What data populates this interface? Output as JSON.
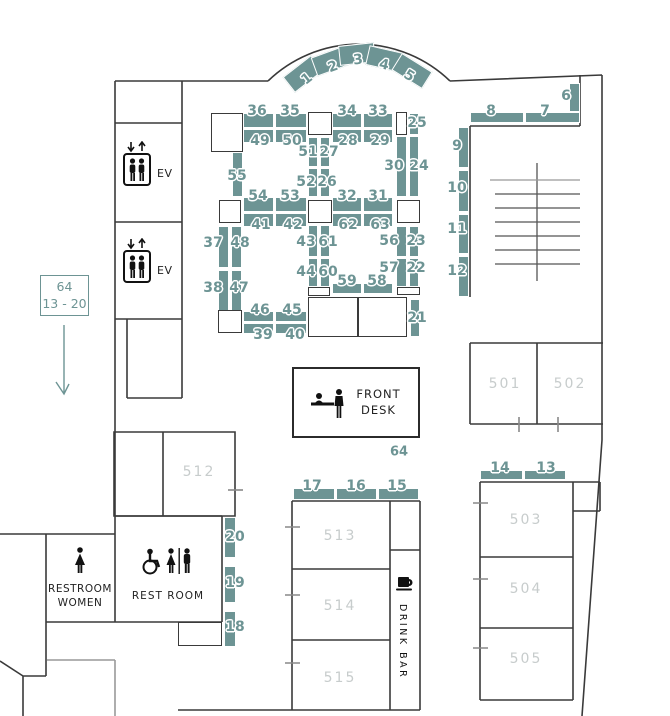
{
  "colors": {
    "booth_fill": "#6d9494",
    "number_text": "#6d9494",
    "room_label_text": "#c7cccc",
    "wall": "#3a3a3a"
  },
  "legend": {
    "text": "64\n13 - 20"
  },
  "elevator": {
    "label": "EV"
  },
  "front_desk": {
    "label": "FRONT\nDESK",
    "booth_num": "64"
  },
  "drink_bar": {
    "label": "DRINK BAR"
  },
  "restrooms": {
    "women": "RESTROOM\nWOMEN",
    "accessible": "REST ROOM"
  },
  "room_labels": [
    {
      "text": "501",
      "x": 505,
      "y": 384
    },
    {
      "text": "502",
      "x": 570,
      "y": 384
    },
    {
      "text": "503",
      "x": 526,
      "y": 520
    },
    {
      "text": "504",
      "x": 526,
      "y": 589
    },
    {
      "text": "505",
      "x": 526,
      "y": 659
    },
    {
      "text": "512",
      "x": 199,
      "y": 472
    },
    {
      "text": "513",
      "x": 340,
      "y": 536
    },
    {
      "text": "514",
      "x": 340,
      "y": 606
    },
    {
      "text": "515",
      "x": 340,
      "y": 678
    }
  ],
  "booths": [
    {
      "n": "1",
      "x": 285,
      "y": 64,
      "w": 36,
      "h": 20,
      "r": -38,
      "lx": 307,
      "ly": 79
    },
    {
      "n": "2",
      "x": 313,
      "y": 51,
      "w": 36,
      "h": 20,
      "r": -20,
      "lx": 333,
      "ly": 67
    },
    {
      "n": "3",
      "x": 339,
      "y": 44,
      "w": 36,
      "h": 20,
      "r": -6,
      "lx": 358,
      "ly": 60
    },
    {
      "n": "4",
      "x": 367,
      "y": 49,
      "w": 36,
      "h": 20,
      "r": 13,
      "lx": 384,
      "ly": 65
    },
    {
      "n": "5",
      "x": 394,
      "y": 61,
      "w": 36,
      "h": 20,
      "r": 32,
      "lx": 409,
      "ly": 76
    },
    {
      "n": "6",
      "x": 569,
      "y": 83,
      "w": 11,
      "h": 29,
      "lx": 566,
      "ly": 96
    },
    {
      "n": "7",
      "x": 525,
      "y": 112,
      "w": 55,
      "h": 11,
      "lx": 545,
      "ly": 111
    },
    {
      "n": "8",
      "x": 470,
      "y": 112,
      "w": 54,
      "h": 11,
      "lx": 491,
      "ly": 111
    },
    {
      "n": "9",
      "x": 458,
      "y": 127,
      "w": 11,
      "h": 41,
      "lx": 457,
      "ly": 146
    },
    {
      "n": "10",
      "x": 458,
      "y": 170,
      "w": 11,
      "h": 42,
      "lx": 457,
      "ly": 188
    },
    {
      "n": "11",
      "x": 458,
      "y": 214,
      "w": 11,
      "h": 40,
      "lx": 457,
      "ly": 229
    },
    {
      "n": "12",
      "x": 458,
      "y": 256,
      "w": 11,
      "h": 41,
      "lx": 457,
      "ly": 271
    },
    {
      "n": "36",
      "x": 243,
      "y": 113,
      "w": 31,
      "h": 15,
      "lx": 257,
      "ly": 111
    },
    {
      "n": "35",
      "x": 275,
      "y": 113,
      "w": 32,
      "h": 15,
      "lx": 290,
      "ly": 111
    },
    {
      "n": "49",
      "x": 243,
      "y": 129,
      "w": 31,
      "h": 14,
      "lx": 260,
      "ly": 141
    },
    {
      "n": "50",
      "x": 275,
      "y": 129,
      "w": 32,
      "h": 14,
      "lx": 292,
      "ly": 141
    },
    {
      "n": "55",
      "x": 232,
      "y": 152,
      "w": 11,
      "h": 45,
      "lx": 237,
      "ly": 176
    },
    {
      "n": "54",
      "x": 243,
      "y": 197,
      "w": 31,
      "h": 15,
      "lx": 258,
      "ly": 196
    },
    {
      "n": "53",
      "x": 275,
      "y": 197,
      "w": 32,
      "h": 15,
      "lx": 290,
      "ly": 196
    },
    {
      "n": "41",
      "x": 243,
      "y": 213,
      "w": 31,
      "h": 14,
      "lx": 261,
      "ly": 225
    },
    {
      "n": "42",
      "x": 275,
      "y": 213,
      "w": 32,
      "h": 14,
      "lx": 293,
      "ly": 225
    },
    {
      "n": "37",
      "x": 218,
      "y": 226,
      "w": 11,
      "h": 42,
      "lx": 213,
      "ly": 243
    },
    {
      "n": "48",
      "x": 231,
      "y": 226,
      "w": 11,
      "h": 42,
      "lx": 240,
      "ly": 243
    },
    {
      "n": "38",
      "x": 218,
      "y": 270,
      "w": 11,
      "h": 42,
      "lx": 213,
      "ly": 288
    },
    {
      "n": "47",
      "x": 231,
      "y": 270,
      "w": 11,
      "h": 42,
      "lx": 239,
      "ly": 288
    },
    {
      "n": "46",
      "x": 243,
      "y": 311,
      "w": 31,
      "h": 11,
      "lx": 260,
      "ly": 310
    },
    {
      "n": "45",
      "x": 275,
      "y": 311,
      "w": 32,
      "h": 11,
      "lx": 292,
      "ly": 310
    },
    {
      "n": "39",
      "x": 243,
      "y": 323,
      "w": 31,
      "h": 11,
      "lx": 263,
      "ly": 335
    },
    {
      "n": "40",
      "x": 275,
      "y": 323,
      "w": 32,
      "h": 11,
      "lx": 295,
      "ly": 335
    },
    {
      "n": "51",
      "x": 308,
      "y": 137,
      "w": 10,
      "h": 30,
      "lx": 308,
      "ly": 152
    },
    {
      "n": "27",
      "x": 320,
      "y": 137,
      "w": 10,
      "h": 30,
      "lx": 329,
      "ly": 152
    },
    {
      "n": "52",
      "x": 308,
      "y": 168,
      "w": 10,
      "h": 29,
      "lx": 306,
      "ly": 182
    },
    {
      "n": "26",
      "x": 320,
      "y": 168,
      "w": 10,
      "h": 29,
      "lx": 327,
      "ly": 182
    },
    {
      "n": "43",
      "x": 308,
      "y": 225,
      "w": 10,
      "h": 32,
      "lx": 306,
      "ly": 242
    },
    {
      "n": "61",
      "x": 320,
      "y": 225,
      "w": 10,
      "h": 32,
      "lx": 328,
      "ly": 242
    },
    {
      "n": "44",
      "x": 308,
      "y": 258,
      "w": 10,
      "h": 29,
      "lx": 306,
      "ly": 272
    },
    {
      "n": "60",
      "x": 320,
      "y": 258,
      "w": 10,
      "h": 29,
      "lx": 328,
      "ly": 272
    },
    {
      "n": "34",
      "x": 332,
      "y": 113,
      "w": 30,
      "h": 15,
      "lx": 347,
      "ly": 111
    },
    {
      "n": "33",
      "x": 363,
      "y": 113,
      "w": 30,
      "h": 15,
      "lx": 378,
      "ly": 111
    },
    {
      "n": "28",
      "x": 332,
      "y": 129,
      "w": 30,
      "h": 14,
      "lx": 348,
      "ly": 141
    },
    {
      "n": "29",
      "x": 363,
      "y": 129,
      "w": 30,
      "h": 14,
      "lx": 380,
      "ly": 141
    },
    {
      "n": "25",
      "x": 409,
      "y": 113,
      "w": 10,
      "h": 22,
      "lx": 417,
      "ly": 123
    },
    {
      "n": "30",
      "x": 396,
      "y": 136,
      "w": 11,
      "h": 61,
      "lx": 394,
      "ly": 166
    },
    {
      "n": "24",
      "x": 409,
      "y": 136,
      "w": 10,
      "h": 61,
      "lx": 419,
      "ly": 166
    },
    {
      "n": "32",
      "x": 332,
      "y": 197,
      "w": 30,
      "h": 15,
      "lx": 347,
      "ly": 196
    },
    {
      "n": "31",
      "x": 363,
      "y": 197,
      "w": 30,
      "h": 15,
      "lx": 378,
      "ly": 196
    },
    {
      "n": "62",
      "x": 332,
      "y": 213,
      "w": 30,
      "h": 14,
      "lx": 348,
      "ly": 225
    },
    {
      "n": "63",
      "x": 363,
      "y": 213,
      "w": 30,
      "h": 14,
      "lx": 380,
      "ly": 225
    },
    {
      "n": "56",
      "x": 396,
      "y": 226,
      "w": 11,
      "h": 31,
      "lx": 389,
      "ly": 241
    },
    {
      "n": "23",
      "x": 409,
      "y": 226,
      "w": 10,
      "h": 31,
      "lx": 416,
      "ly": 241
    },
    {
      "n": "57",
      "x": 396,
      "y": 258,
      "w": 11,
      "h": 29,
      "lx": 389,
      "ly": 268
    },
    {
      "n": "22",
      "x": 409,
      "y": 258,
      "w": 10,
      "h": 29,
      "lx": 416,
      "ly": 268
    },
    {
      "n": "59",
      "x": 332,
      "y": 283,
      "w": 30,
      "h": 11,
      "lx": 347,
      "ly": 281
    },
    {
      "n": "58",
      "x": 363,
      "y": 283,
      "w": 30,
      "h": 11,
      "lx": 377,
      "ly": 281
    },
    {
      "n": "21",
      "x": 410,
      "y": 299,
      "w": 10,
      "h": 38,
      "lx": 417,
      "ly": 318
    },
    {
      "n": "17",
      "x": 293,
      "y": 488,
      "w": 42,
      "h": 12,
      "lx": 312,
      "ly": 486
    },
    {
      "n": "16",
      "x": 336,
      "y": 488,
      "w": 41,
      "h": 12,
      "lx": 356,
      "ly": 486
    },
    {
      "n": "15",
      "x": 378,
      "y": 488,
      "w": 41,
      "h": 12,
      "lx": 397,
      "ly": 486
    },
    {
      "n": "14",
      "x": 480,
      "y": 470,
      "w": 43,
      "h": 10,
      "lx": 500,
      "ly": 468
    },
    {
      "n": "13",
      "x": 524,
      "y": 470,
      "w": 42,
      "h": 10,
      "lx": 546,
      "ly": 468
    },
    {
      "n": "20",
      "x": 224,
      "y": 517,
      "w": 12,
      "h": 41,
      "lx": 235,
      "ly": 537
    },
    {
      "n": "19",
      "x": 224,
      "y": 566,
      "w": 12,
      "h": 37,
      "lx": 235,
      "ly": 583
    },
    {
      "n": "18",
      "x": 224,
      "y": 611,
      "w": 12,
      "h": 36,
      "lx": 235,
      "ly": 627
    }
  ],
  "pillars": [
    {
      "x": 211,
      "y": 113,
      "w": 32,
      "h": 39
    },
    {
      "x": 308,
      "y": 112,
      "w": 24,
      "h": 23
    },
    {
      "x": 396,
      "y": 112,
      "w": 11,
      "h": 23
    },
    {
      "x": 219,
      "y": 200,
      "w": 22,
      "h": 23
    },
    {
      "x": 308,
      "y": 200,
      "w": 24,
      "h": 23
    },
    {
      "x": 397,
      "y": 200,
      "w": 23,
      "h": 23
    },
    {
      "x": 218,
      "y": 310,
      "w": 24,
      "h": 23
    },
    {
      "x": 308,
      "y": 287,
      "w": 22,
      "h": 9
    },
    {
      "x": 397,
      "y": 287,
      "w": 23,
      "h": 8
    },
    {
      "x": 308,
      "y": 297,
      "w": 50,
      "h": 40
    },
    {
      "x": 358,
      "y": 297,
      "w": 49,
      "h": 40
    },
    {
      "x": 178,
      "y": 622,
      "w": 44,
      "h": 24
    }
  ]
}
